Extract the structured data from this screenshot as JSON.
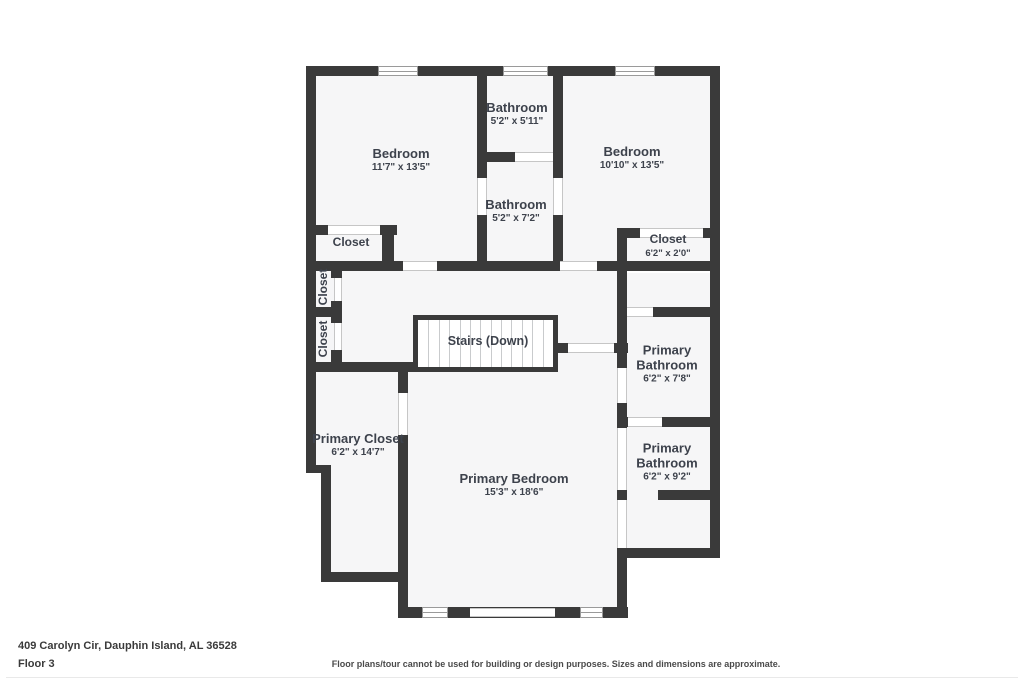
{
  "plan": {
    "rooms": [
      {
        "name": "Bathroom",
        "dims": "5'2\" x 5'11\""
      },
      {
        "name": "Bedroom",
        "dims": "11'7\" x 13'5\""
      },
      {
        "name": "Bedroom",
        "dims": "10'10\" x 13'5\""
      },
      {
        "name": "Bathroom",
        "dims": "5'2\" x 7'2\""
      },
      {
        "name": "Closet",
        "dims": ""
      },
      {
        "name": "Closet",
        "dims": "6'2\" x 2'0\""
      },
      {
        "name": "Closet",
        "dims": ""
      },
      {
        "name": "Closet",
        "dims": ""
      },
      {
        "name": "Stairs (Down)",
        "dims": ""
      },
      {
        "name": "Primary Bathroom",
        "dims": "6'2\" x 7'8\""
      },
      {
        "name": "Primary Closet",
        "dims": "6'2\" x 14'7\""
      },
      {
        "name": "Primary Bathroom",
        "dims": "6'2\" x 9'2\""
      },
      {
        "name": "Primary Bedroom",
        "dims": "15'3\" x 18'6\""
      }
    ]
  },
  "footer": {
    "address": "409 Carolyn Cir, Dauphin Island, AL 36528",
    "floor_label": "Floor 3",
    "disclaimer": "Floor plans/tour cannot be used for building or design purposes. Sizes and dimensions are approximate."
  },
  "colors": {
    "wall": "#3a3a3a",
    "floor": "#f6f6f7",
    "label_text": "#3d424c"
  }
}
